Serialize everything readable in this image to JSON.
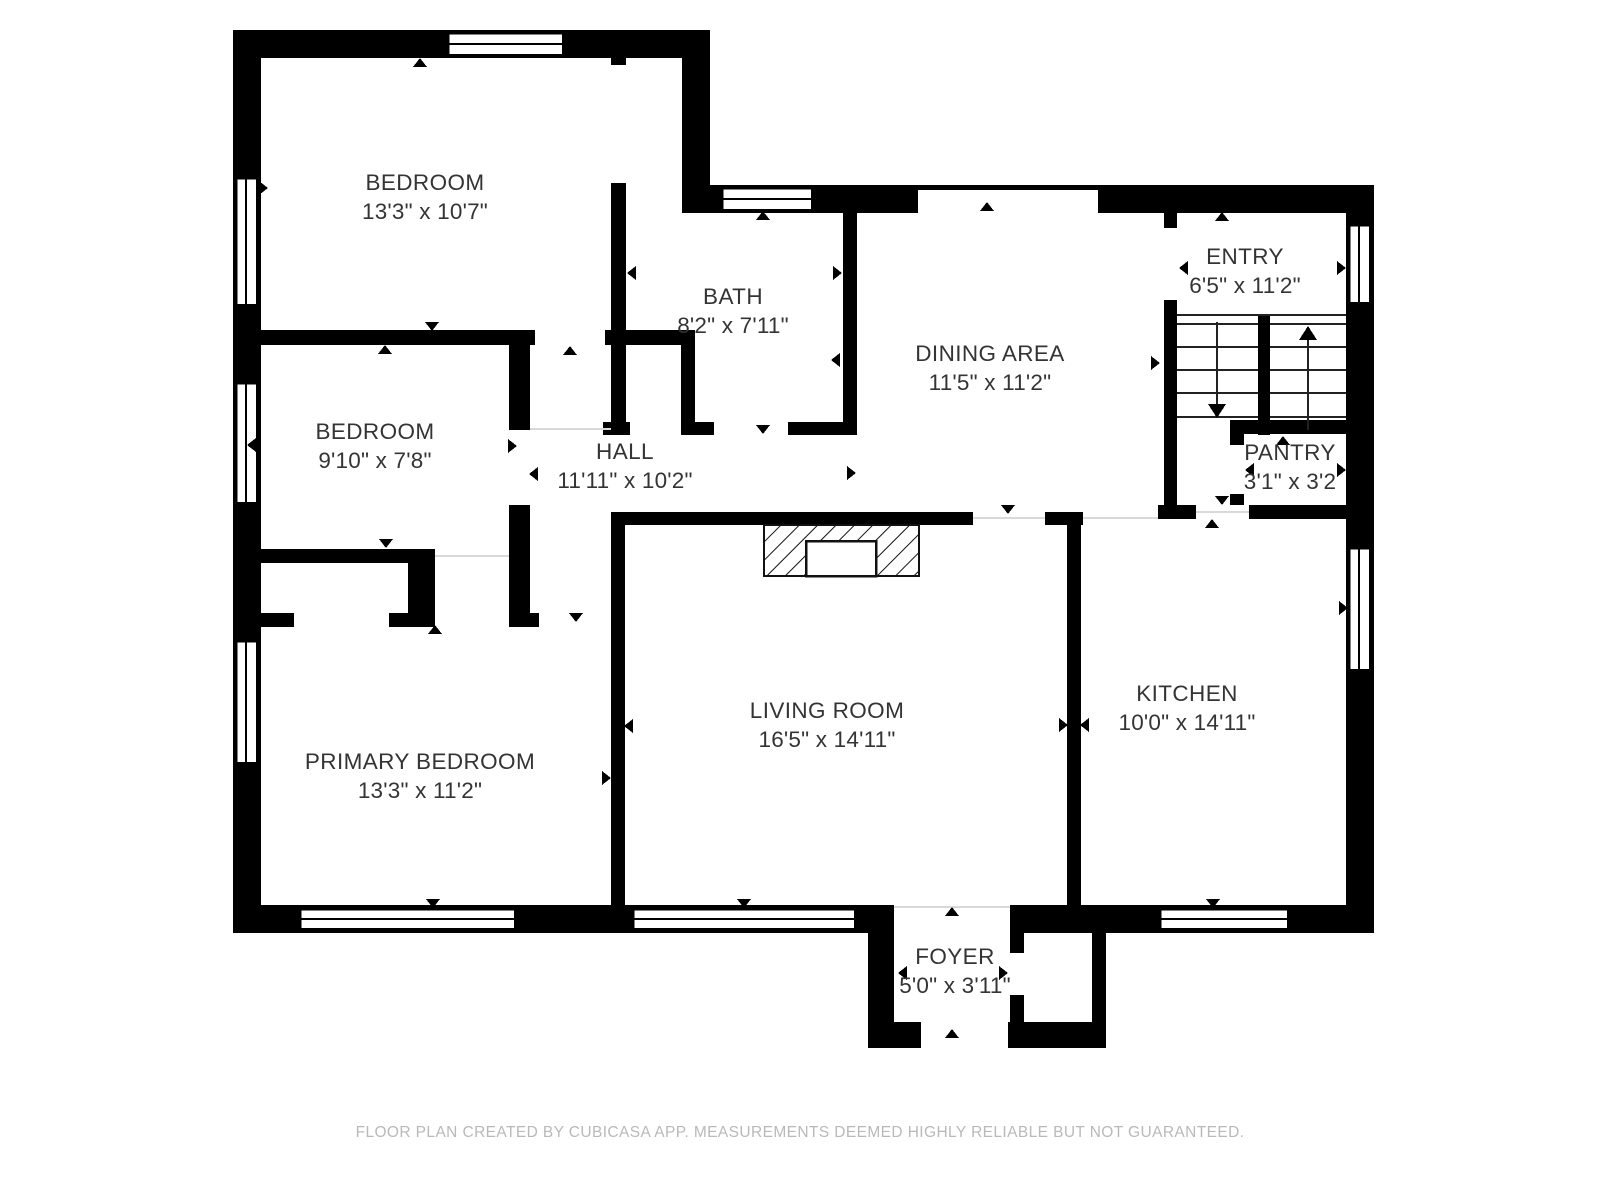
{
  "rooms": [
    {
      "name": "BEDROOM",
      "dims": "13'3\" x 10'7\""
    },
    {
      "name": "BATH",
      "dims": "8'2\" x 7'11\""
    },
    {
      "name": "DINING AREA",
      "dims": "11'5\" x 11'2\""
    },
    {
      "name": "ENTRY",
      "dims": "6'5\" x 11'2\""
    },
    {
      "name": "BEDROOM",
      "dims": "9'10\" x 7'8\""
    },
    {
      "name": "HALL",
      "dims": "11'11\" x 10'2\""
    },
    {
      "name": "PANTRY",
      "dims": "3'1\" x 3'2"
    },
    {
      "name": "PRIMARY BEDROOM",
      "dims": "13'3\" x 11'2\""
    },
    {
      "name": "LIVING ROOM",
      "dims": "16'5\" x 14'11\""
    },
    {
      "name": "KITCHEN",
      "dims": "10'0\" x 14'11\""
    },
    {
      "name": "FOYER",
      "dims": "5'0\" x 3'11\""
    }
  ],
  "footer": {
    "text": "FLOOR PLAN CREATED BY CUBICASA APP. MEASUREMENTS DEEMED HIGHLY RELIABLE BUT NOT GUARANTEED."
  },
  "colors": {
    "wall": "#000000",
    "label": "#343434",
    "footer": "#b9b9b9"
  }
}
